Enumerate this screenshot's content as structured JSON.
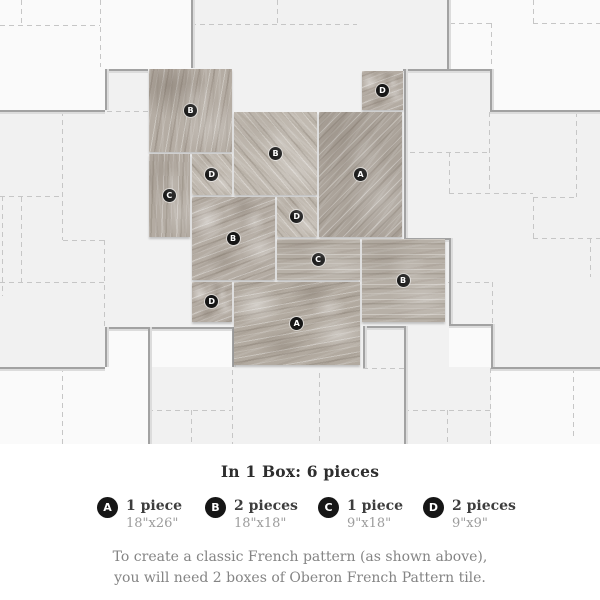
{
  "colors": {
    "pattern_bg": "#f1f1f1",
    "dash_line": "#c6c6c6",
    "boundary_line": "#a2a2a2",
    "badge_bg": "#161616",
    "badge_text": "#ffffff"
  },
  "diagram": {
    "tiles": [
      {
        "label": "B",
        "x": 148,
        "y": 68,
        "w": 85,
        "h": 85,
        "texture": "peak"
      },
      {
        "label": "C",
        "x": 148,
        "y": 153,
        "w": 42.5,
        "h": 85,
        "texture": "vert"
      },
      {
        "label": "D",
        "x": 190.5,
        "y": 153,
        "w": 42.5,
        "h": 42.5,
        "texture": "soft"
      },
      {
        "label": "B",
        "x": 233,
        "y": 110.5,
        "w": 85,
        "h": 85,
        "texture": "soft"
      },
      {
        "label": "D",
        "x": 361,
        "y": 69.5,
        "w": 43,
        "h": 41,
        "texture": "blotch"
      },
      {
        "label": "A",
        "x": 318,
        "y": 110.5,
        "w": 85,
        "h": 127.5,
        "texture": "diag"
      },
      {
        "label": "B",
        "x": 190.5,
        "y": 195.5,
        "w": 85,
        "h": 85,
        "texture": "blotch"
      },
      {
        "label": "D",
        "x": 275.5,
        "y": 195.5,
        "w": 42.5,
        "h": 42.5,
        "texture": "soft"
      },
      {
        "label": "C",
        "x": 275.5,
        "y": 238,
        "w": 85,
        "h": 42.5,
        "texture": "horiz"
      },
      {
        "label": "B",
        "x": 360.5,
        "y": 238,
        "w": 85,
        "h": 85,
        "texture": "horiz"
      },
      {
        "label": "D",
        "x": 190.5,
        "y": 280.5,
        "w": 42.5,
        "h": 42.5,
        "texture": "blotch"
      },
      {
        "label": "A",
        "x": 233,
        "y": 280.5,
        "w": 127.5,
        "h": 85,
        "texture": "blotch2"
      }
    ],
    "dashed_h": [
      [
        25,
        0,
        100
      ],
      [
        24,
        191,
        357
      ],
      [
        23,
        450,
        491
      ],
      [
        23,
        533,
        600
      ],
      [
        111,
        107,
        148
      ],
      [
        152,
        410,
        489
      ],
      [
        193,
        449,
        533
      ],
      [
        196,
        0,
        62
      ],
      [
        197,
        533,
        576
      ],
      [
        238,
        533,
        600
      ],
      [
        240,
        63,
        104
      ],
      [
        282,
        0,
        104
      ],
      [
        282,
        448,
        492
      ],
      [
        368,
        363,
        404
      ],
      [
        410,
        148,
        231
      ],
      [
        410,
        404,
        490
      ]
    ],
    "dashed_v": [
      [
        21,
        0,
        25
      ],
      [
        100,
        0,
        67
      ],
      [
        277,
        0,
        24
      ],
      [
        533,
        0,
        23
      ],
      [
        491,
        23,
        68
      ],
      [
        62,
        111,
        240
      ],
      [
        2,
        196,
        296
      ],
      [
        21,
        197,
        282
      ],
      [
        489,
        112,
        192
      ],
      [
        576,
        112,
        197
      ],
      [
        449,
        152,
        193
      ],
      [
        533,
        197,
        238
      ],
      [
        590,
        238,
        277
      ],
      [
        104,
        240,
        327
      ],
      [
        492,
        282,
        323
      ],
      [
        62,
        367,
        444
      ],
      [
        191,
        410,
        444
      ],
      [
        232,
        370,
        444
      ],
      [
        319,
        373,
        444
      ],
      [
        447,
        410,
        444
      ],
      [
        490,
        368,
        444
      ],
      [
        573,
        368,
        440
      ]
    ],
    "solid_h": [
      [
        110,
        0,
        105
      ],
      [
        69,
        105,
        148
      ],
      [
        69,
        403,
        490
      ],
      [
        110,
        490,
        600
      ],
      [
        238,
        404,
        449
      ],
      [
        324,
        449,
        491
      ],
      [
        326,
        363,
        404
      ],
      [
        327,
        105,
        233
      ],
      [
        367,
        0,
        105
      ],
      [
        367,
        491,
        600
      ]
    ],
    "solid_v": [
      [
        191,
        0,
        68
      ],
      [
        447,
        0,
        69
      ],
      [
        105,
        69,
        110
      ],
      [
        490,
        69,
        110
      ],
      [
        404,
        69,
        238
      ],
      [
        449,
        238,
        324
      ],
      [
        491,
        324,
        367
      ],
      [
        105,
        327,
        367
      ],
      [
        148,
        327,
        444
      ],
      [
        232,
        327,
        367
      ],
      [
        363,
        326,
        368
      ],
      [
        404,
        326,
        444
      ]
    ],
    "white_patches": [
      [
        0,
        0,
        105,
        110
      ],
      [
        105,
        0,
        86,
        69
      ],
      [
        447,
        0,
        153,
        69
      ],
      [
        490,
        69,
        110,
        41
      ],
      [
        0,
        367,
        148,
        77
      ],
      [
        105,
        327,
        128,
        40
      ],
      [
        491,
        368,
        109,
        76
      ],
      [
        449,
        324,
        42,
        43
      ]
    ]
  },
  "info": {
    "title": "In 1 Box: 6 pieces",
    "legend": [
      {
        "label": "A",
        "count": "1 piece",
        "size": "18\"x26\""
      },
      {
        "label": "B",
        "count": "2 pieces",
        "size": "18\"x18\""
      },
      {
        "label": "C",
        "count": "1 piece",
        "size": "9\"x18\""
      },
      {
        "label": "D",
        "count": "2 pieces",
        "size": "9\"x9\""
      }
    ],
    "note_line1": "To create a classic French pattern (as shown above),",
    "note_line2": "you will need 2 boxes of Oberon French Pattern tile."
  }
}
